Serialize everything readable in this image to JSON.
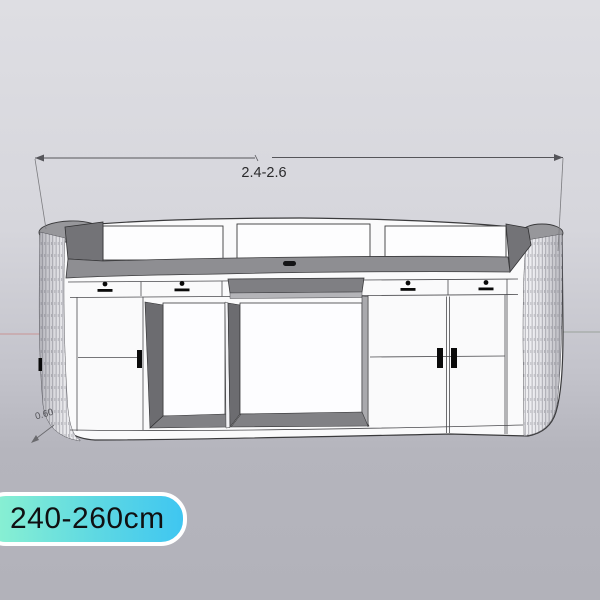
{
  "dimensions": {
    "width_label": "2.4-2.6",
    "depth_label": "0.60"
  },
  "badge": {
    "label": "240-260cm",
    "gradient_start": "#8ef3d0",
    "gradient_end": "#3fc6f1",
    "border_color": "#ffffff",
    "text_color": "#101012"
  },
  "colors": {
    "background_top": "#dedee3",
    "background_bottom": "#b2b2ba",
    "cabinet_face": "#fafafb",
    "countertop": "#8e8e92",
    "dark_interior": "#6c6c70",
    "end_cap_top": "#97979b",
    "outline": "#3a3a3c",
    "axis_left": "#c99494",
    "axis_right": "#9aa29b"
  }
}
